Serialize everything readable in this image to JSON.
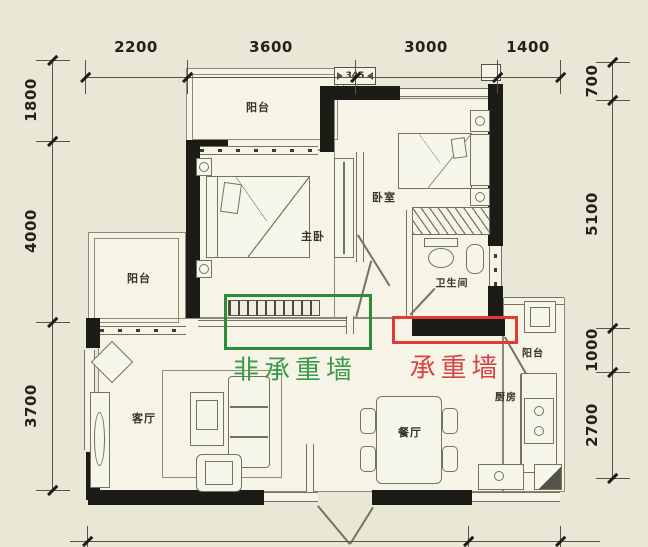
{
  "dimensions": {
    "top": [
      "2200",
      "3600",
      "3000",
      "1400"
    ],
    "left": [
      "1800",
      "4000",
      "3700"
    ],
    "right": [
      "700",
      "5100",
      "1000",
      "2700"
    ]
  },
  "rooms": {
    "balcony_top": "阳台",
    "master_bedroom": "主卧",
    "bedroom": "卧室",
    "bathroom": "卫生间",
    "balcony_left": "阳台",
    "living_room": "客厅",
    "dining_room": "餐厅",
    "kitchen": "厨房",
    "balcony_kitchen": "阳台"
  },
  "annotations": {
    "non_load_bearing": {
      "label": "非承重墙",
      "text_color": "#3a9a4a",
      "box_color": "#2e8b3b"
    },
    "load_bearing": {
      "label": "承重墙",
      "text_color": "#d94343",
      "box_color": "#e23b33"
    }
  },
  "window_tag": "345",
  "colors": {
    "background": "#e9e8d6",
    "floor": "#f5f4e7",
    "wall": "#1c1c17",
    "plan_line": "#73735f",
    "dimension_line": "#55544a"
  }
}
